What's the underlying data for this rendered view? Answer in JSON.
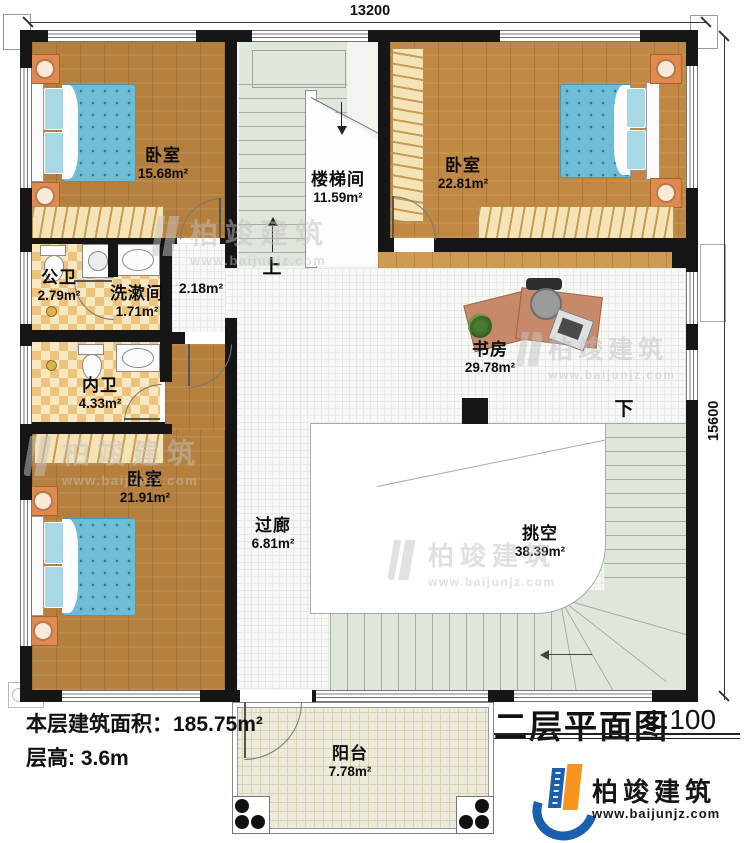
{
  "dimensions": {
    "top": "13200",
    "right": "15600"
  },
  "rooms": {
    "bedroom_tl": {
      "name": "卧室",
      "area": "15.68m²"
    },
    "stairwell": {
      "name": "楼梯间",
      "area": "11.59m²"
    },
    "bedroom_tr": {
      "name": "卧室",
      "area": "22.81m²"
    },
    "public_bath": {
      "name": "公卫",
      "area": "2.79m²"
    },
    "washroom": {
      "name": "洗漱间",
      "area": "1.71m²"
    },
    "hallway": {
      "area": "2.18m²"
    },
    "study": {
      "name": "书房",
      "area": "29.78m²"
    },
    "private_bath": {
      "name": "内卫",
      "area": "4.33m²"
    },
    "bedroom_bl": {
      "name": "卧室",
      "area": "21.91m²"
    },
    "corridor": {
      "name": "过廊",
      "area": "6.81m²"
    },
    "void": {
      "name": "挑空",
      "area": "38.39m²"
    },
    "balcony": {
      "name": "阳台",
      "area": "7.78m²"
    }
  },
  "stairs": {
    "up": "上",
    "down": "下"
  },
  "footer": {
    "area_line": "本层建筑面积：185.75m²",
    "height_line": "层高: 3.6m"
  },
  "titleblock": {
    "title": "二层平面图",
    "scale": "1:100"
  },
  "brand": {
    "name": "柏竣建筑",
    "url": "www.baijunjz.com"
  },
  "watermark": {
    "name": "柏竣建筑",
    "url": "www.baijunjz.com"
  },
  "colors": {
    "wall": "#161616",
    "wood": "#b5803e",
    "wood_band": "#cf9a55",
    "bed": "#6fbcd6",
    "stairs": "#dfe6dc",
    "tile": "#ecc47e",
    "balcony": "#eeeadb",
    "brand_blue": "#1b5fad",
    "brand_orange": "#f7941d"
  }
}
